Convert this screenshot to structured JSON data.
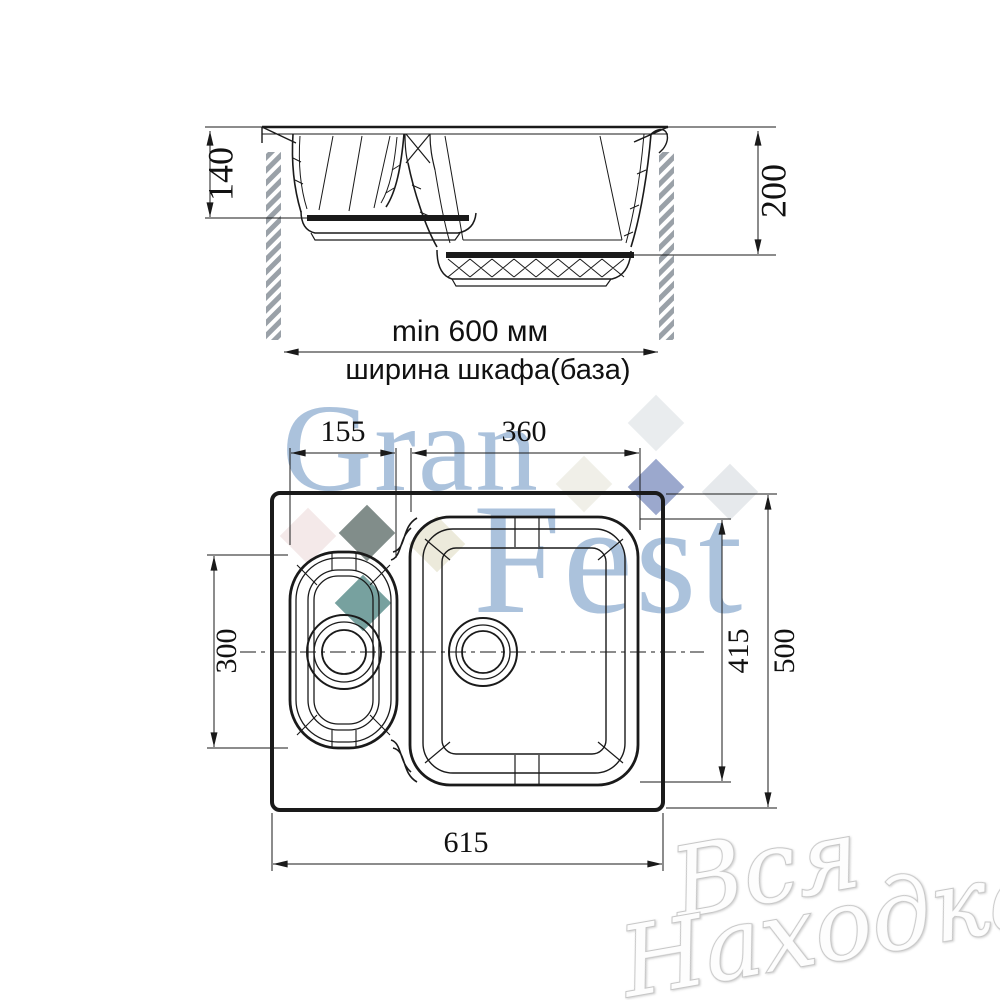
{
  "drawing": {
    "section_view": {
      "small_bowl_depth_mm": "140",
      "main_bowl_depth_mm": "200",
      "cabinet_min_width": "min 600 мм",
      "cabinet_width_caption": "ширина шкафа(база)"
    },
    "plan_view": {
      "small_bowl_width_mm": "155",
      "main_bowl_width_mm": "360",
      "small_bowl_length_mm": "300",
      "main_bowl_length_mm": "415",
      "overall_length_mm": "500",
      "overall_width_mm": "615"
    }
  },
  "watermarks": {
    "brand_top": "Gran",
    "brand_bottom": "Fest",
    "brand_color": "#a3bcd9",
    "store_line1": "Вся",
    "store_line2": "Находка",
    "diamonds": [
      {
        "color": "#e7eaed"
      },
      {
        "color": "#efeee6"
      },
      {
        "color": "#8a99c4"
      },
      {
        "color": "#e4e7ea"
      },
      {
        "color": "#f3e7e7"
      },
      {
        "color": "#707d7a"
      },
      {
        "color": "#5f918e"
      },
      {
        "color": "#eae8d8"
      }
    ]
  },
  "colors": {
    "line": "#1a1a1a",
    "hatch": "#9aa1a8",
    "background": "#ffffff"
  }
}
